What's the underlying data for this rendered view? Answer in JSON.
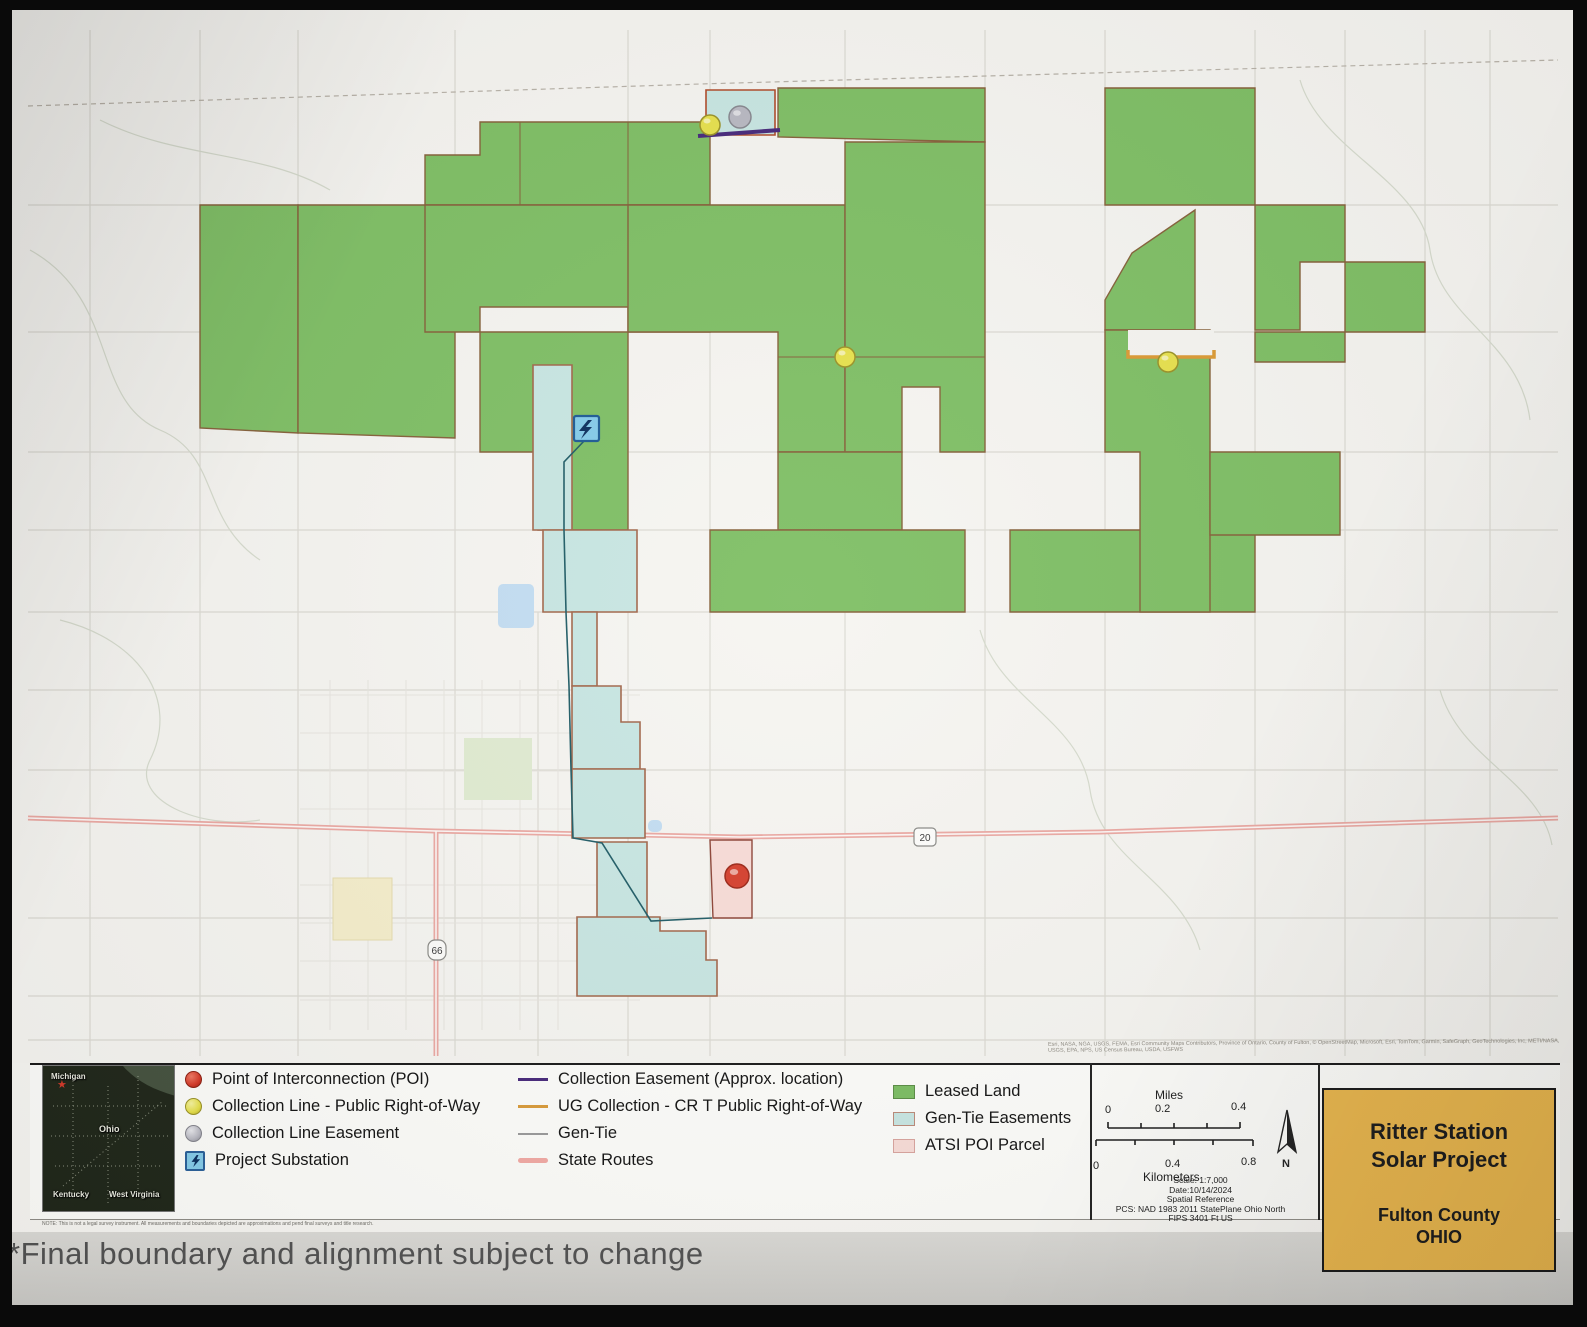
{
  "caption": "*Final boundary and alignment subject to change",
  "note": "NOTE: This is not a legal survey instrument. All measurements and boundaries depicted are approximations and pend final surveys and title research.",
  "credits": "Esri, NASA, NGA, USGS, FEMA, Esri Community Maps Contributors, Province of Ontario, County of Fulton, © OpenStreetMap, Microsoft, Esri, TomTom, Garmin, SafeGraph, GeoTechnologies, Inc, METI/NASA, USGS, EPA, NPS, US Census Bureau, USDA, USFWS",
  "inset": {
    "nw": "Michigan",
    "center": "Ohio",
    "sw": "Kentucky",
    "se": "West Virginia",
    "star": "★",
    "star_color": "#d43a2a"
  },
  "legend": {
    "col1": [
      {
        "icon": "poi-dot",
        "label": "Point of Interconnection (POI)"
      },
      {
        "icon": "yellow-dot",
        "label": "Collection Line - Public Right-of-Way"
      },
      {
        "icon": "gray-dot",
        "label": "Collection Line Easement"
      },
      {
        "icon": "substation",
        "label": "Project Substation"
      }
    ],
    "col2": [
      {
        "icon": "purple-line",
        "label": "Collection Easement (Approx. location)"
      },
      {
        "icon": "orange-line",
        "label": "UG Collection - CR T Public Right-of-Way"
      },
      {
        "icon": "gray-line",
        "label": "Gen-Tie"
      },
      {
        "icon": "pink-line",
        "label": "State Routes"
      }
    ],
    "col3": [
      {
        "icon": "green-area",
        "label": "Leased Land"
      },
      {
        "icon": "teal-area",
        "label": "Gen-Tie Easements"
      },
      {
        "icon": "pink-area",
        "label": "ATSI POI Parcel"
      }
    ]
  },
  "scalebar": {
    "miles_label": "Miles",
    "miles_ticks": [
      "0",
      "0.2",
      "0.4"
    ],
    "km_ticks": [
      "0",
      "0.4",
      "0.8"
    ],
    "km_label": "Kilometers",
    "north": "N",
    "details": [
      "Scale: 1:7,000",
      "Date:10/14/2024",
      "Spatial Reference",
      "PCS: NAD 1983 2011 StatePlane Ohio North",
      "FIPS 3401 Ft US"
    ]
  },
  "title_box": {
    "line1": "Ritter Station",
    "line2": "Solar Project",
    "county": "Fulton County",
    "state": "OHIO",
    "bg": "#e9b64d"
  },
  "map": {
    "bg": "#f6f5f1",
    "road_color": "#dcdad3",
    "town_color": "#e7e5df",
    "stream_color": "#d6dbcd",
    "dash_color": "#b8b2a8",
    "green_fill": "#7fbf65",
    "green_stroke": "#86613a",
    "teal_fill": "#c8e6e2",
    "teal_stroke": "#a2674b",
    "tealtop_stroke": "#b04a28",
    "pink_fill": "#f8dcd7",
    "pink_stroke": "#8d4437",
    "route_color": "#eba9a3",
    "route_core": "#fdf7f5",
    "purple": "#47297b",
    "orange": "#dc9a34",
    "gentie": "#205c66",
    "roads_v": [
      [
        90,
        30,
        1056
      ],
      [
        200,
        30,
        1056
      ],
      [
        298,
        30,
        1056
      ],
      [
        455,
        30,
        1056
      ],
      [
        538,
        612,
        1056
      ],
      [
        628,
        30,
        1056
      ],
      [
        710,
        30,
        1056
      ],
      [
        845,
        30,
        1056
      ],
      [
        985,
        30,
        1056
      ],
      [
        1105,
        30,
        1056
      ],
      [
        1255,
        30,
        1056
      ],
      [
        1345,
        30,
        1056
      ],
      [
        1425,
        30,
        1056
      ],
      [
        1490,
        30,
        1056
      ]
    ],
    "roads_h": [
      [
        205,
        28,
        1558
      ],
      [
        332,
        28,
        1558
      ],
      [
        452,
        28,
        1558
      ],
      [
        530,
        28,
        1558
      ],
      [
        612,
        28,
        1558
      ],
      [
        690,
        28,
        1558
      ],
      [
        770,
        28,
        1558
      ],
      [
        918,
        28,
        1558
      ],
      [
        996,
        28,
        1558
      ],
      [
        1040,
        28,
        1558
      ]
    ],
    "town_v": [
      [
        330,
        680,
        1030
      ],
      [
        368,
        680,
        1030
      ],
      [
        406,
        680,
        1030
      ],
      [
        444,
        680,
        1030
      ],
      [
        482,
        680,
        1030
      ],
      [
        520,
        680,
        1030
      ],
      [
        558,
        680,
        1030
      ]
    ],
    "town_h": [
      [
        695,
        300,
        640
      ],
      [
        733,
        300,
        640
      ],
      [
        771,
        300,
        640
      ],
      [
        809,
        300,
        640
      ],
      [
        885,
        300,
        640
      ],
      [
        923,
        300,
        640
      ],
      [
        961,
        300,
        640
      ],
      [
        1000,
        300,
        640
      ]
    ],
    "streams": [
      "M30,250 C120,300 90,400 160,430 C220,455 200,520 260,560",
      "M60,620 C140,640 180,700 150,760 C130,800 200,830 260,820",
      "M980,630 C1000,700 1080,720 1090,790 C1100,860 1180,880 1200,950",
      "M1300,80 C1320,150 1420,180 1430,250 C1440,320 1520,340 1530,420",
      "M1440,690 C1460,760 1540,780 1552,845",
      "M100,120 C180,160 260,150 330,190"
    ],
    "dashed": [
      "M28,106 L700,84 L1558,60"
    ],
    "green": [
      "200,205 298,205 298,433 200,428",
      "298,205 455,205 455,438 298,433",
      "425,155 480,155 480,122 710,122 710,205 425,205",
      "778,88 985,88 985,142 778,137",
      "425,205 710,205 710,332 628,332 628,307 480,307 480,332 425,332",
      "628,205 845,205 845,452 778,452 778,332 628,332",
      "845,142 985,142 985,452 940,452 940,387 902,387 902,452 845,452",
      "480,332 628,332 628,530 538,530 538,452 480,452",
      "778,452 902,452 902,530 778,530",
      "710,530 965,530 965,612 710,612",
      "1010,530 1255,530 1255,612 1010,612",
      "1105,88 1255,88 1255,205 1105,205",
      "1195,210 1195,330 1105,330 1105,300 1132,253",
      "1255,205 1345,205 1345,262 1300,262 1300,330 1255,330",
      "1345,262 1425,262 1425,332 1345,332",
      "1255,332 1345,332 1345,362 1255,362",
      "1105,330 1210,330 1210,612 1140,612 1140,452 1105,452",
      "1210,452 1340,452 1340,535 1210,535"
    ],
    "holes": [
      [
        1128,
        330,
        86,
        27
      ]
    ],
    "dividers": [
      [
        298,
        205,
        298,
        433
      ],
      [
        628,
        122,
        628,
        205
      ],
      [
        845,
        205,
        845,
        452
      ],
      [
        778,
        357,
        985,
        357
      ],
      [
        520,
        122,
        520,
        205
      ]
    ],
    "teal": [
      "533,365 572,365 572,530 533,530",
      "543,530 637,530 637,612 543,612",
      "572,612 597,612 597,686 572,686",
      "572,686 621,686 621,722 640,722 640,769 572,769",
      "572,769 645,769 645,838 572,838",
      "597,842 647,842 647,918 597,918",
      "577,917 660,917 660,931 706,931 706,960 717,960 717,996 577,996"
    ],
    "teal_top": "706,90 775,90 775,135 706,135",
    "pink": "710,840 752,840 752,918 713,918",
    "routes": [
      "M28,818 L435,831 L740,837 L1100,832 L1558,818",
      "M436,831 L436,1056"
    ],
    "purple_line": "M698,136 L780,130",
    "orange_line": "M1128,350 L1128,357 L1214,357 L1214,350",
    "gentie_line": "M585,440 L564,462 L564,530 L566,612 L569,686 L571,769 L573,838 L602,843 L651,921 L712,918",
    "ponds": [
      [
        498,
        584,
        36,
        44
      ],
      [
        1120,
        388,
        52,
        30
      ],
      [
        648,
        820,
        14,
        12
      ]
    ],
    "cemetery": [
      333,
      878,
      59,
      62
    ],
    "park": [
      464,
      738,
      68,
      62
    ],
    "shields": [
      {
        "x": 925,
        "y": 837,
        "label": "20",
        "type": "us-route"
      },
      {
        "x": 437,
        "y": 950,
        "label": "66",
        "type": "state-route"
      }
    ],
    "pins": [
      {
        "x": 710,
        "y": 125,
        "r": 10,
        "fill": "#e7e14d",
        "stroke": "#9a9227",
        "name": "collection-line-row-pin"
      },
      {
        "x": 845,
        "y": 357,
        "r": 10,
        "fill": "#e7e14d",
        "stroke": "#9a9227",
        "name": "collection-line-row-pin"
      },
      {
        "x": 1168,
        "y": 362,
        "r": 10,
        "fill": "#e7e14d",
        "stroke": "#9a9227",
        "name": "collection-line-row-pin"
      },
      {
        "x": 740,
        "y": 117,
        "r": 11,
        "fill": "#b9b9c2",
        "stroke": "#87878f",
        "name": "collection-easement-pin"
      },
      {
        "x": 737,
        "y": 876,
        "r": 12,
        "fill": "#d6402e",
        "stroke": "#9c2718",
        "name": "poi-marker"
      }
    ],
    "substation": {
      "x": 574,
      "y": 416,
      "size": 25
    }
  }
}
